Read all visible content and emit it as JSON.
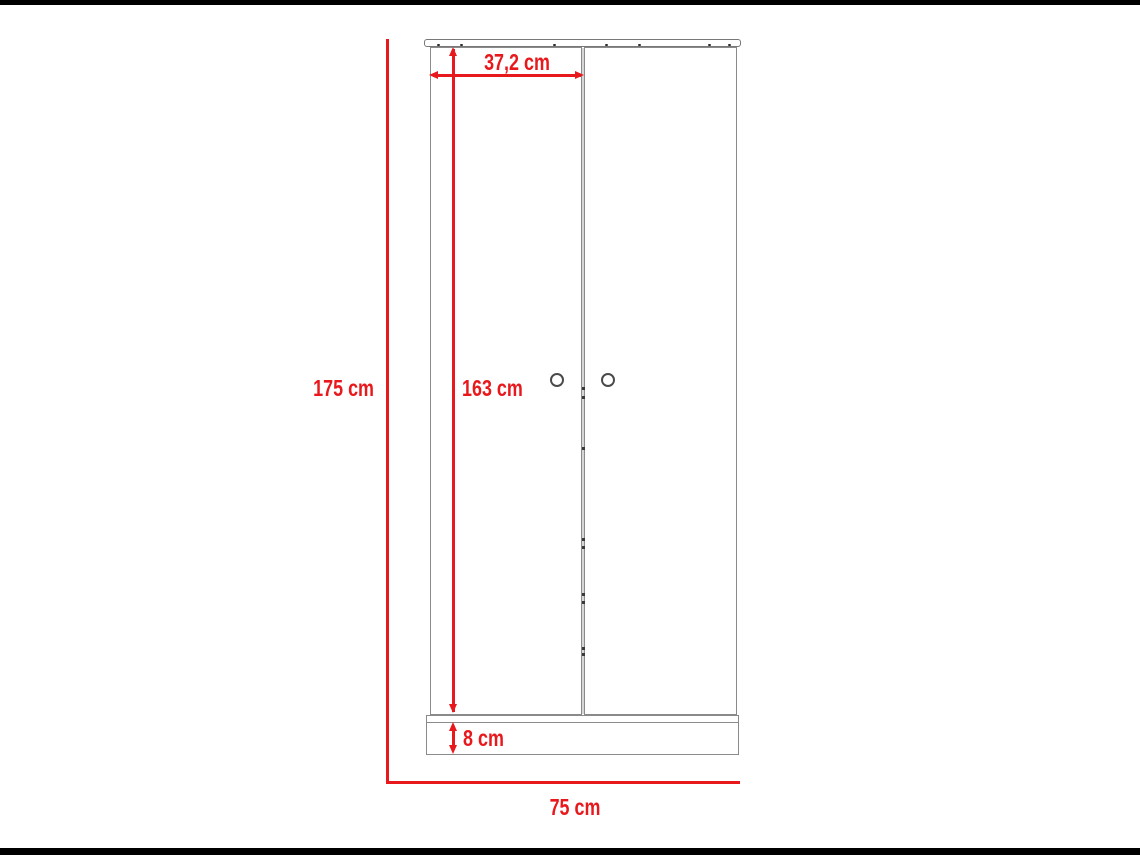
{
  "colors": {
    "dimension_red": "#e8191d",
    "outline_gray": "#8a8a8a",
    "lid_outline_gray": "#777777",
    "handle_gray": "#4a4a4a",
    "background": "#ffffff",
    "letterbox": "#000000"
  },
  "diagram": {
    "subject": "two-door-wardrobe-front-elevation",
    "labels": {
      "total_height": "175 cm",
      "total_width": "75 cm",
      "door_height": "163 cm",
      "door_width": "37,2 cm",
      "base_height": "8 cm"
    },
    "measurements_cm": {
      "total_height": 175,
      "total_width": 75,
      "door_height": 163,
      "door_width": 37.2,
      "base_height": 8
    }
  }
}
